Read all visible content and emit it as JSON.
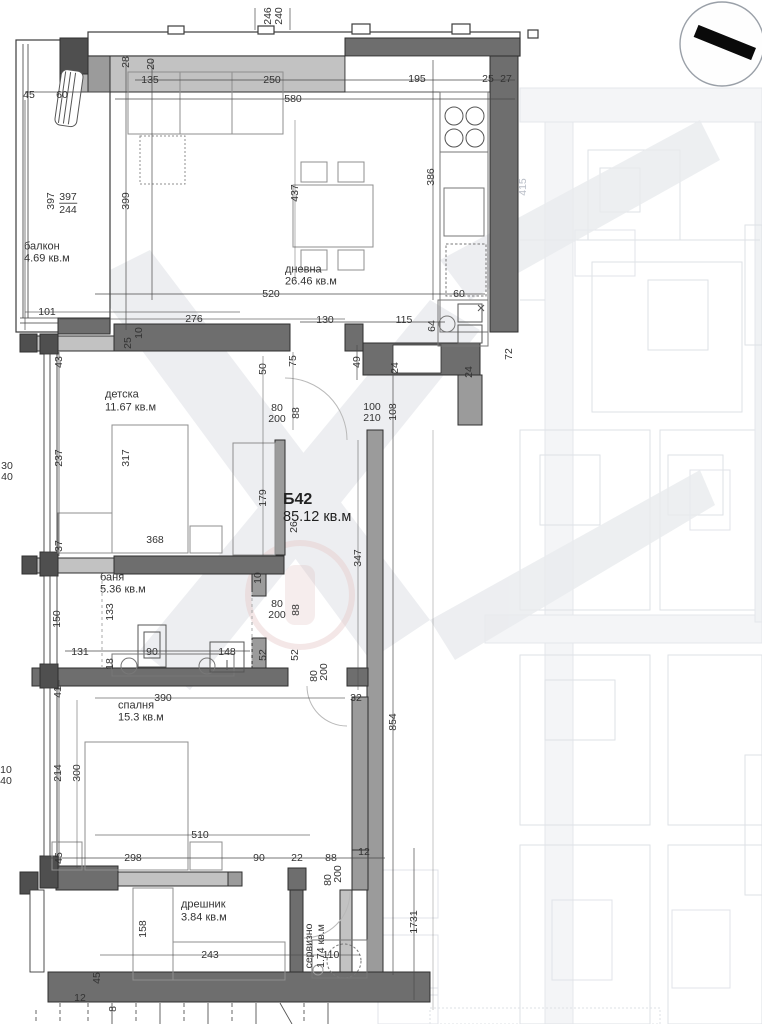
{
  "drawing": {
    "type": "apartment-floor-plan",
    "unit": {
      "id": "Б42",
      "total_area": "85.12 кв.м"
    },
    "rooms": [
      {
        "name": "балкон",
        "area": "4.69 кв.м"
      },
      {
        "name": "дневна",
        "area": "26.46 кв.м"
      },
      {
        "name": "детска",
        "area": "11.67 кв.м"
      },
      {
        "name": "баня",
        "area": "5.36 кв.м"
      },
      {
        "name": "спалня",
        "area": "15.3 кв.м"
      },
      {
        "name": "дрешник",
        "area": "3.84 кв.м"
      },
      {
        "name": "сервизно",
        "area": "1.74 кв.м"
      }
    ]
  },
  "colors": {
    "wall_dark": "#6e6e6e",
    "wall_mid": "#9b9b9b",
    "wall_light": "#c2c2c2",
    "corner_dark": "#4f4f4f",
    "line": "#2f2f2f",
    "furniture": "#8f8f8f",
    "dimension_text": "#333333",
    "background_faint": "#d9dde3"
  },
  "icons": [
    {
      "name": "north-compass-icon",
      "shape": "circle-with-black-bar"
    }
  ],
  "labels": [
    {
      "t": "246",
      "x": 268,
      "y": 16,
      "c": "v"
    },
    {
      "t": "240",
      "x": 279,
      "y": 16,
      "c": "v"
    },
    {
      "t": "20",
      "x": 151,
      "y": 64,
      "c": "v"
    },
    {
      "t": "28",
      "x": 126,
      "y": 62,
      "c": "v"
    },
    {
      "t": "45",
      "x": 29,
      "y": 95,
      "c": "dim"
    },
    {
      "t": "60",
      "x": 62,
      "y": 95,
      "c": "dim"
    },
    {
      "t": "135",
      "x": 150,
      "y": 80,
      "c": "dim"
    },
    {
      "t": "250",
      "x": 272,
      "y": 80,
      "c": "dim"
    },
    {
      "t": "195",
      "x": 417,
      "y": 79,
      "c": "dim"
    },
    {
      "t": "25",
      "x": 488,
      "y": 79,
      "c": "dim"
    },
    {
      "t": "27",
      "x": 506,
      "y": 79,
      "c": "dim"
    },
    {
      "t": "580",
      "x": 293,
      "y": 99,
      "c": "dim"
    },
    {
      "t": "397",
      "x": 51,
      "y": 201,
      "c": "v"
    },
    {
      "t": "397",
      "x": 68,
      "y": 197,
      "c": "dim"
    },
    {
      "t": "244",
      "x": 68,
      "y": 209,
      "c": "dim frac"
    },
    {
      "t": "399",
      "x": 126,
      "y": 201,
      "c": "v"
    },
    {
      "t": "балкон",
      "x": 24,
      "y": 247,
      "c": "room"
    },
    {
      "t": "4.69 кв.м",
      "x": 24,
      "y": 259,
      "c": "area"
    },
    {
      "t": "437",
      "x": 295,
      "y": 193,
      "c": "v"
    },
    {
      "t": "386",
      "x": 431,
      "y": 177,
      "c": "v"
    },
    {
      "t": "415",
      "x": 523,
      "y": 187,
      "c": "faintv"
    },
    {
      "t": "дневна",
      "x": 285,
      "y": 270,
      "c": "room"
    },
    {
      "t": "26.46 кв.м",
      "x": 285,
      "y": 282,
      "c": "area"
    },
    {
      "t": "520",
      "x": 271,
      "y": 294,
      "c": "dim"
    },
    {
      "t": "60",
      "x": 459,
      "y": 294,
      "c": "dim"
    },
    {
      "t": "101",
      "x": 47,
      "y": 312,
      "c": "dim"
    },
    {
      "t": "276",
      "x": 194,
      "y": 319,
      "c": "dim"
    },
    {
      "t": "130",
      "x": 325,
      "y": 320,
      "c": "dim"
    },
    {
      "t": "115",
      "x": 404,
      "y": 320,
      "c": "dim"
    },
    {
      "t": "64",
      "x": 432,
      "y": 326,
      "c": "v"
    },
    {
      "t": "25",
      "x": 128,
      "y": 343,
      "c": "v"
    },
    {
      "t": "10",
      "x": 139,
      "y": 333,
      "c": "v"
    },
    {
      "t": "43",
      "x": 59,
      "y": 362,
      "c": "v"
    },
    {
      "t": "75",
      "x": 293,
      "y": 361,
      "c": "v"
    },
    {
      "t": "50",
      "x": 263,
      "y": 369,
      "c": "v"
    },
    {
      "t": "49",
      "x": 357,
      "y": 362,
      "c": "v"
    },
    {
      "t": "24",
      "x": 395,
      "y": 368,
      "c": "v"
    },
    {
      "t": "24",
      "x": 469,
      "y": 372,
      "c": "v"
    },
    {
      "t": "72",
      "x": 509,
      "y": 354,
      "c": "v"
    },
    {
      "t": "80",
      "x": 277,
      "y": 408,
      "c": "dim"
    },
    {
      "t": "200",
      "x": 277,
      "y": 419,
      "c": "dim"
    },
    {
      "t": "88",
      "x": 296,
      "y": 413,
      "c": "v"
    },
    {
      "t": "100",
      "x": 372,
      "y": 407,
      "c": "dim"
    },
    {
      "t": "210",
      "x": 372,
      "y": 418,
      "c": "dim"
    },
    {
      "t": "108",
      "x": 393,
      "y": 412,
      "c": "v"
    },
    {
      "t": "детска",
      "x": 105,
      "y": 395,
      "c": "room"
    },
    {
      "t": "11.67 кв.м",
      "x": 105,
      "y": 408,
      "c": "area"
    },
    {
      "t": "237",
      "x": 59,
      "y": 458,
      "c": "v"
    },
    {
      "t": "317",
      "x": 126,
      "y": 458,
      "c": "v"
    },
    {
      "t": "179",
      "x": 263,
      "y": 498,
      "c": "v"
    },
    {
      "t": "30",
      "x": 7,
      "y": 466,
      "c": "dim"
    },
    {
      "t": "40",
      "x": 7,
      "y": 477,
      "c": "dim"
    },
    {
      "t": "Б42",
      "x": 283,
      "y": 500,
      "c": "unit"
    },
    {
      "t": "85.12 кв.м",
      "x": 283,
      "y": 517,
      "c": "unitarea"
    },
    {
      "t": "26",
      "x": 294,
      "y": 527,
      "c": "v"
    },
    {
      "t": "368",
      "x": 155,
      "y": 540,
      "c": "dim"
    },
    {
      "t": "37",
      "x": 59,
      "y": 546,
      "c": "v"
    },
    {
      "t": "347",
      "x": 358,
      "y": 558,
      "c": "v"
    },
    {
      "t": "баня",
      "x": 100,
      "y": 578,
      "c": "room"
    },
    {
      "t": "5.36 кв.м",
      "x": 100,
      "y": 590,
      "c": "area"
    },
    {
      "t": "10",
      "x": 258,
      "y": 578,
      "c": "v"
    },
    {
      "t": "80",
      "x": 277,
      "y": 604,
      "c": "dim"
    },
    {
      "t": "200",
      "x": 277,
      "y": 615,
      "c": "dim"
    },
    {
      "t": "88",
      "x": 296,
      "y": 610,
      "c": "v"
    },
    {
      "t": "150",
      "x": 57,
      "y": 619,
      "c": "v"
    },
    {
      "t": "133",
      "x": 110,
      "y": 612,
      "c": "v"
    },
    {
      "t": "131",
      "x": 80,
      "y": 652,
      "c": "dim"
    },
    {
      "t": "90",
      "x": 152,
      "y": 652,
      "c": "dim"
    },
    {
      "t": "148",
      "x": 227,
      "y": 652,
      "c": "dim"
    },
    {
      "t": "52",
      "x": 263,
      "y": 655,
      "c": "v"
    },
    {
      "t": "52",
      "x": 295,
      "y": 655,
      "c": "v"
    },
    {
      "t": "18",
      "x": 110,
      "y": 664,
      "c": "v"
    },
    {
      "t": "80",
      "x": 314,
      "y": 676,
      "c": "v"
    },
    {
      "t": "200",
      "x": 324,
      "y": 672,
      "c": "v"
    },
    {
      "t": "41",
      "x": 58,
      "y": 692,
      "c": "v"
    },
    {
      "t": "390",
      "x": 163,
      "y": 698,
      "c": "dim"
    },
    {
      "t": "32",
      "x": 356,
      "y": 698,
      "c": "dim"
    },
    {
      "t": "спалня",
      "x": 118,
      "y": 706,
      "c": "room"
    },
    {
      "t": "15.3 кв.м",
      "x": 118,
      "y": 718,
      "c": "area"
    },
    {
      "t": "214",
      "x": 58,
      "y": 773,
      "c": "v"
    },
    {
      "t": "300",
      "x": 77,
      "y": 773,
      "c": "v"
    },
    {
      "t": "10",
      "x": 6,
      "y": 770,
      "c": "dim"
    },
    {
      "t": "40",
      "x": 6,
      "y": 781,
      "c": "dim"
    },
    {
      "t": "854",
      "x": 393,
      "y": 722,
      "c": "v"
    },
    {
      "t": "510",
      "x": 200,
      "y": 835,
      "c": "dim"
    },
    {
      "t": "45",
      "x": 59,
      "y": 858,
      "c": "v"
    },
    {
      "t": "298",
      "x": 133,
      "y": 858,
      "c": "dim"
    },
    {
      "t": "90",
      "x": 259,
      "y": 858,
      "c": "dim"
    },
    {
      "t": "22",
      "x": 297,
      "y": 858,
      "c": "dim"
    },
    {
      "t": "88",
      "x": 331,
      "y": 858,
      "c": "dim"
    },
    {
      "t": "12",
      "x": 364,
      "y": 852,
      "c": "dim"
    },
    {
      "t": "80",
      "x": 328,
      "y": 880,
      "c": "v"
    },
    {
      "t": "200",
      "x": 338,
      "y": 874,
      "c": "v"
    },
    {
      "t": "158",
      "x": 143,
      "y": 929,
      "c": "v"
    },
    {
      "t": "дрешник",
      "x": 181,
      "y": 905,
      "c": "room"
    },
    {
      "t": "3.84 кв.м",
      "x": 181,
      "y": 918,
      "c": "area"
    },
    {
      "t": "243",
      "x": 210,
      "y": 955,
      "c": "dim"
    },
    {
      "t": "110",
      "x": 331,
      "y": 955,
      "c": "dim"
    },
    {
      "t": "сервизно",
      "x": 309,
      "y": 946,
      "c": "v"
    },
    {
      "t": "1.74 кв.м",
      "x": 321,
      "y": 946,
      "c": "v"
    },
    {
      "t": "1731",
      "x": 414,
      "y": 922,
      "c": "v"
    },
    {
      "t": "45",
      "x": 97,
      "y": 978,
      "c": "v"
    },
    {
      "t": "12",
      "x": 80,
      "y": 998,
      "c": "dim"
    },
    {
      "t": "8",
      "x": 113,
      "y": 1009,
      "c": "v"
    }
  ]
}
